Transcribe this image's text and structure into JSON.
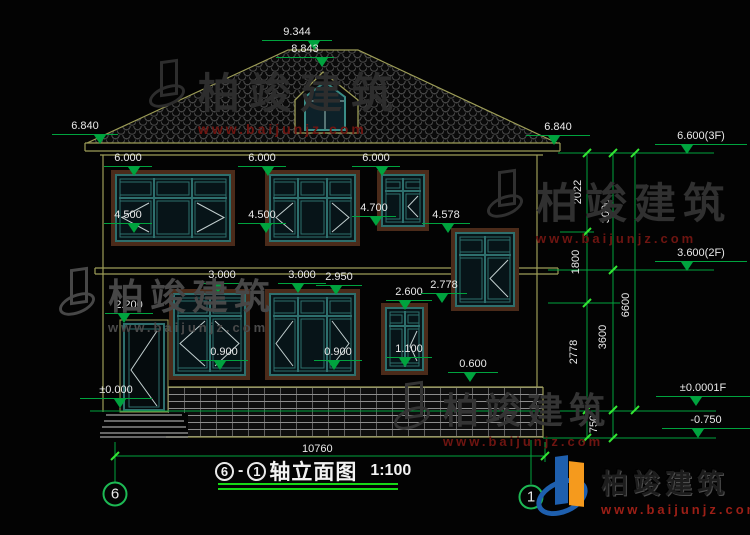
{
  "colors": {
    "background": "#030303",
    "outline_yellow": "#9d9d57",
    "frame_brown": "#4b2b1a",
    "frame_teal": "#2e6f6d",
    "dim_green": "#00a33e",
    "tick_green": "#33e633",
    "underline_green": "#16d916",
    "text_white": "#e9e9e9",
    "watermark_red": "#6e1511",
    "logo_blue": "#1e5fae",
    "logo_orange": "#f59a1d"
  },
  "drawing": {
    "title": {
      "axis_from": "6",
      "axis_to": "1",
      "name": "轴立面图",
      "scale": "1:100"
    },
    "overall_width": "10760",
    "levels": [
      {
        "label": "9.344",
        "x": 262,
        "w": 70,
        "bar": 40,
        "tri": 52
      },
      {
        "label": "8.843",
        "x": 276,
        "w": 58,
        "bar": 57,
        "tri": 46
      },
      {
        "label": "6.840",
        "x": 52,
        "w": 66,
        "bar": 134,
        "tri": 48
      },
      {
        "label": "6.840",
        "x": 526,
        "w": 64,
        "bar": 135,
        "tri": 28
      },
      {
        "label": "6.600(3F)",
        "x": 655,
        "w": 92,
        "bar": 144,
        "tri": 32
      },
      {
        "label": "6.000",
        "x": 104,
        "w": 48,
        "bar": 166,
        "tri": 30
      },
      {
        "label": "6.000",
        "x": 238,
        "w": 48,
        "bar": 166,
        "tri": 30
      },
      {
        "label": "6.000",
        "x": 352,
        "w": 48,
        "bar": 166,
        "tri": 30
      },
      {
        "label": "4.500",
        "x": 104,
        "w": 48,
        "bar": 223,
        "tri": 30
      },
      {
        "label": "4.500",
        "x": 238,
        "w": 48,
        "bar": 223,
        "tri": 28
      },
      {
        "label": "4.700",
        "x": 352,
        "w": 44,
        "bar": 216,
        "tri": 24
      },
      {
        "label": "4.578",
        "x": 422,
        "w": 48,
        "bar": 223,
        "tri": 26
      },
      {
        "label": "3.000",
        "x": 198,
        "w": 48,
        "bar": 283,
        "tri": 20
      },
      {
        "label": "3.000",
        "x": 278,
        "w": 48,
        "bar": 283,
        "tri": 20
      },
      {
        "label": "2.950",
        "x": 316,
        "w": 46,
        "bar": 285,
        "tri": 20
      },
      {
        "label": "2.600",
        "x": 386,
        "w": 46,
        "bar": 300,
        "tri": 19
      },
      {
        "label": "2.778",
        "x": 421,
        "w": 46,
        "bar": 293,
        "tri": 21
      },
      {
        "label": "2.200",
        "x": 105,
        "w": 48,
        "bar": 313,
        "tri": 19
      },
      {
        "label": "±0.000",
        "x": 80,
        "w": 72,
        "bar": 398,
        "tri": 40
      },
      {
        "label": "0.900",
        "x": 200,
        "w": 48,
        "bar": 360,
        "tri": 20
      },
      {
        "label": "0.900",
        "x": 314,
        "w": 48,
        "bar": 360,
        "tri": 20
      },
      {
        "label": "1.100",
        "x": 386,
        "w": 46,
        "bar": 357,
        "tri": 19
      },
      {
        "label": "0.600",
        "x": 448,
        "w": 50,
        "bar": 372,
        "tri": 22
      },
      {
        "label": "3.600(2F)",
        "x": 655,
        "w": 92,
        "bar": 261,
        "tri": 32
      },
      {
        "label": "±0.0001F",
        "x": 656,
        "w": 94,
        "bar": 396,
        "tri": 40
      },
      {
        "label": "-0.750",
        "x": 662,
        "w": 88,
        "bar": 428,
        "tri": 36
      }
    ],
    "vertical_dims": [
      {
        "label": "2022",
        "x": 578,
        "y": 192
      },
      {
        "label": "3000",
        "x": 606,
        "y": 211
      },
      {
        "label": "1800",
        "x": 576,
        "y": 262
      },
      {
        "label": "2778",
        "x": 574,
        "y": 352
      },
      {
        "label": "3600",
        "x": 603,
        "y": 337
      },
      {
        "label": "6600",
        "x": 626,
        "y": 305
      },
      {
        "label": "750",
        "x": 594,
        "y": 424
      }
    ],
    "axis_bubbles": [
      {
        "label": "6",
        "cx": 115,
        "cy": 494
      },
      {
        "label": "1",
        "cx": 531,
        "cy": 497
      }
    ],
    "windows": [
      {
        "x": 115,
        "y": 174,
        "w": 116,
        "h": 68,
        "t": 0.36,
        "cols": 3,
        "ch": [
          "L",
          "",
          "R"
        ]
      },
      {
        "x": 269,
        "y": 174,
        "w": 87,
        "h": 68,
        "t": 0.36,
        "cols": 3,
        "ch": [
          "L",
          "",
          "R"
        ]
      },
      {
        "x": 381,
        "y": 174,
        "w": 44,
        "h": 53,
        "t": 0.33,
        "cols": 2,
        "ch": [
          "",
          "L"
        ]
      },
      {
        "x": 455,
        "y": 232,
        "w": 60,
        "h": 75,
        "t": 0.3,
        "cols": 2,
        "ch": [
          "",
          "L"
        ]
      },
      {
        "x": 173,
        "y": 293,
        "w": 73,
        "h": 83,
        "t": 0.28,
        "cols": 2,
        "ch": [
          "L",
          "R"
        ]
      },
      {
        "x": 269,
        "y": 293,
        "w": 87,
        "h": 83,
        "t": 0.28,
        "cols": 3,
        "ch": [
          "L",
          "",
          "R"
        ]
      },
      {
        "x": 385,
        "y": 307,
        "w": 39,
        "h": 64,
        "t": 0.3,
        "cols": 2,
        "ch": [
          "",
          "L"
        ]
      }
    ]
  },
  "watermarks": [
    {
      "x": 148,
      "y": 60,
      "brand": "柏竣建筑",
      "url": "www.baijunjz.com",
      "tone": "#2d2d2d",
      "urlTone": "#6e1511",
      "size": 42,
      "ls": 9,
      "usize": 14
    },
    {
      "x": 58,
      "y": 268,
      "brand": "柏竣建筑",
      "url": "www.baijunjz.com",
      "tone": "#474747",
      "urlTone": "#4a4a4a",
      "size": 36,
      "ls": 6,
      "usize": 13
    },
    {
      "x": 393,
      "y": 382,
      "brand": "柏竣建筑",
      "url": "www.baijunjz.com",
      "tone": "#343434",
      "urlTone": "#6e1511",
      "size": 36,
      "ls": 6,
      "usize": 13
    },
    {
      "x": 486,
      "y": 170,
      "brand": "柏竣建筑",
      "url": "www.baijunjz.com",
      "tone": "#303030",
      "urlTone": "#6e1511",
      "size": 42,
      "ls": 7,
      "usize": 13
    }
  ],
  "logo": {
    "brand": "柏竣建筑",
    "url": "www.baijunjz.com"
  }
}
